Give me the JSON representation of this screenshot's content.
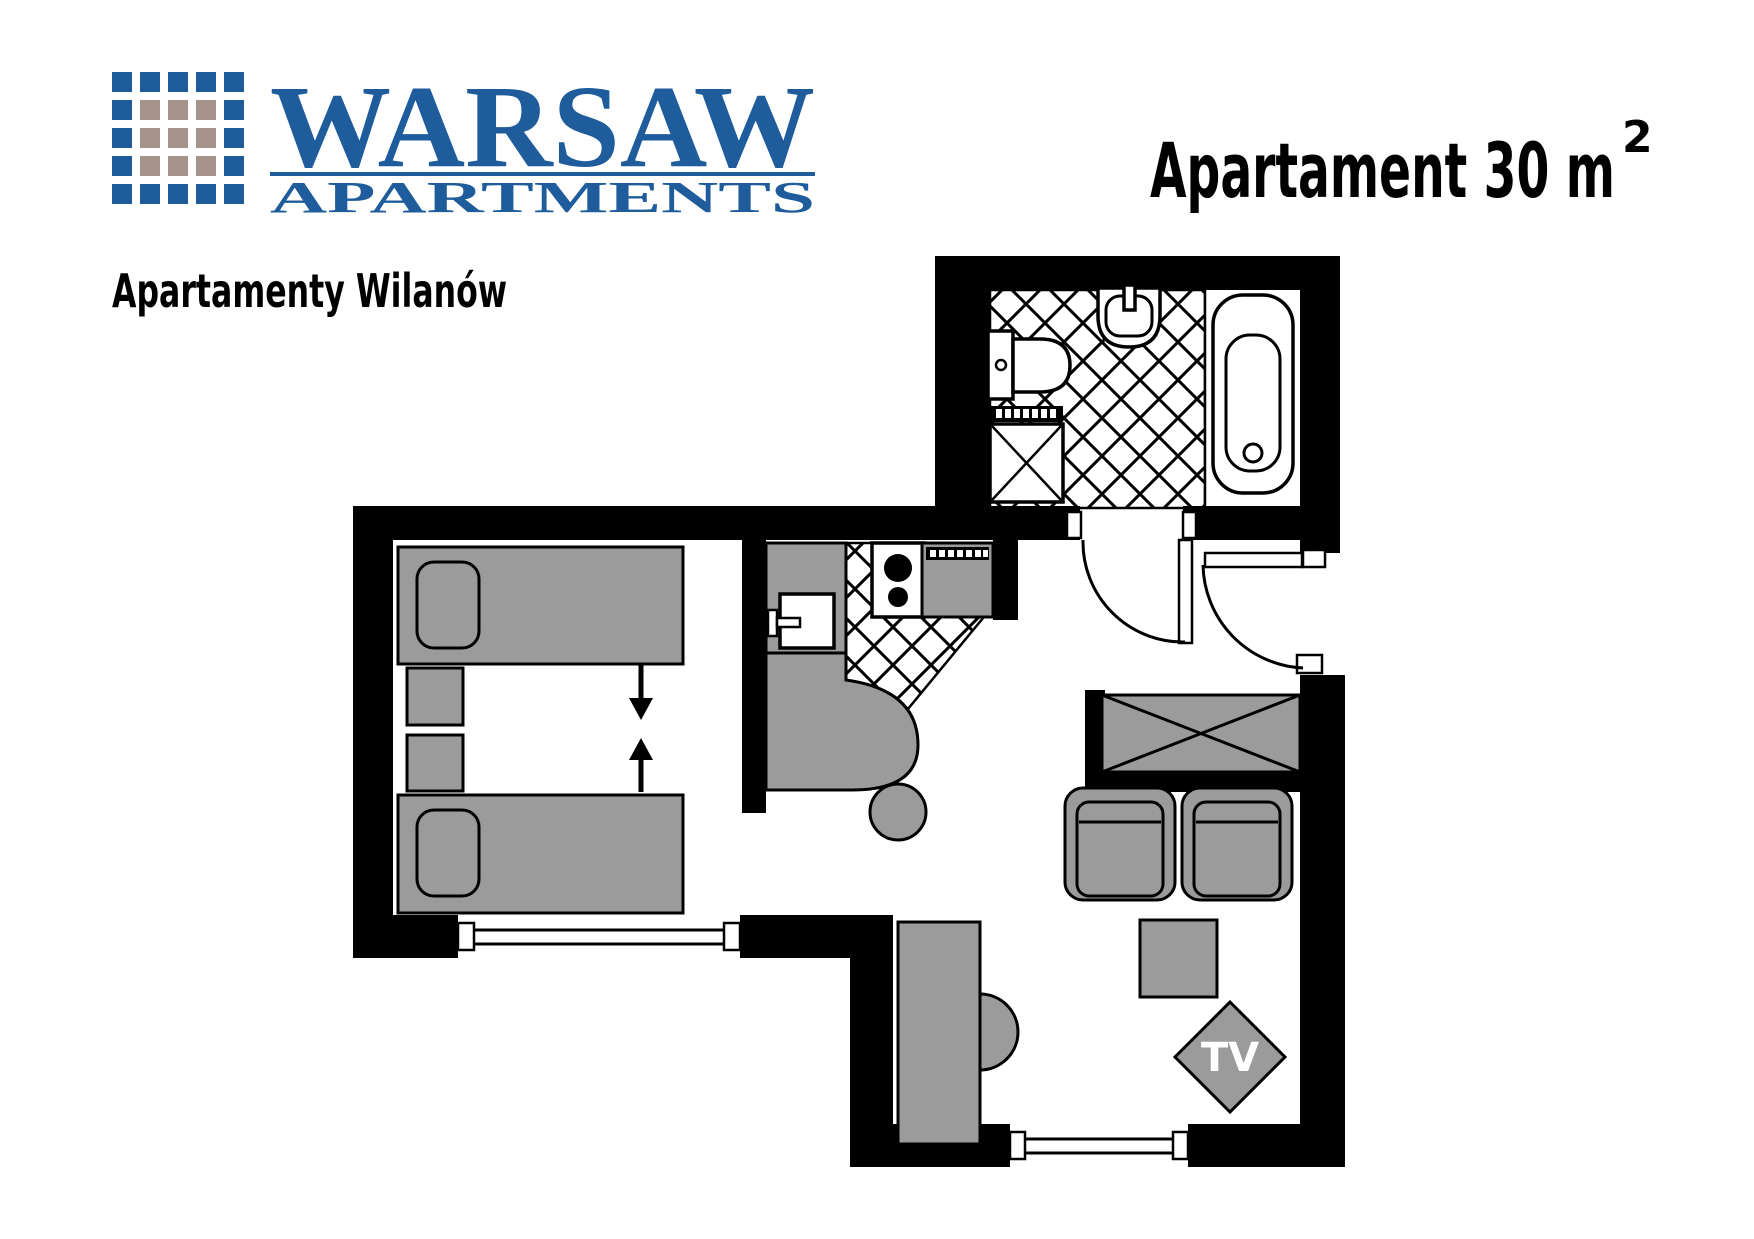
{
  "colors": {
    "brand-blue": "#1e5c9c",
    "brand-beige": "#a6938b",
    "wall": "#000000",
    "furniture": "#9b9b9b",
    "line": "#000000",
    "bg": "#ffffff",
    "tv-text": "#ffffff"
  },
  "branding": {
    "wordmark": "WARSAW",
    "wordmark_sub": "APARTMENTS",
    "tagline": "Apartamenty Wilanów",
    "logo_grid": "5x5-squares-blue-ring-beige-center"
  },
  "title": {
    "main": "Apartament 30 m",
    "superscript": "2"
  },
  "floorplan": {
    "tv_label": "TV",
    "symbols": [
      "bathtub",
      "washbasin",
      "toilet",
      "washing-machine",
      "radiator-strip",
      "kitchen-sink",
      "stove-two-burners",
      "kitchen-appliance",
      "kitchen-counter",
      "bar-stool",
      "single-bed",
      "pillow",
      "nightstand",
      "push-together-arrows",
      "wardrobe",
      "armchair",
      "coffee-table",
      "tv-set",
      "desk",
      "desk-chair",
      "door-swing",
      "window",
      "tiled-floor"
    ]
  }
}
